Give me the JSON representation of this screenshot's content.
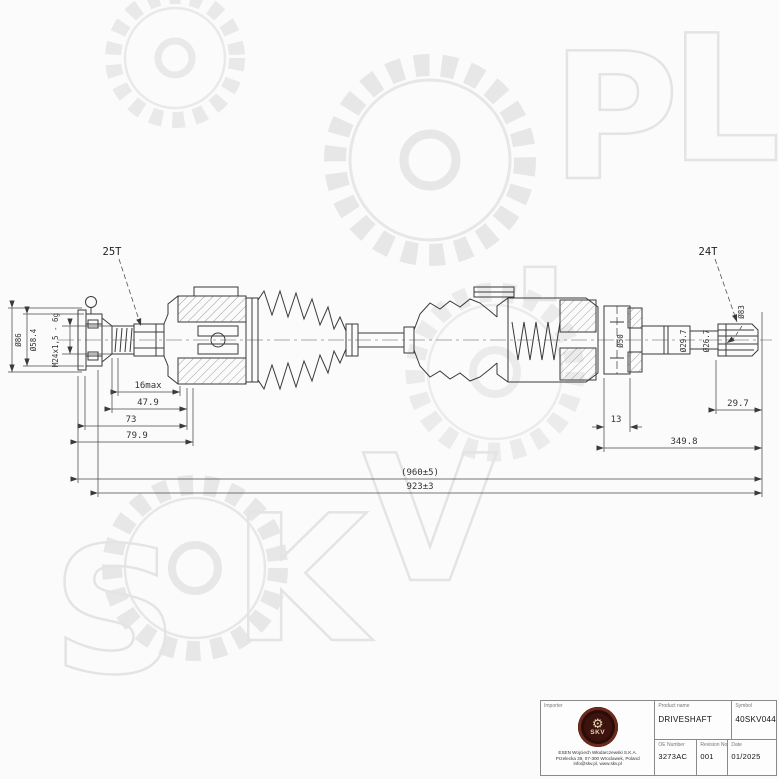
{
  "watermark": {
    "letters": [
      "S",
      "K",
      "V",
      ".",
      "P",
      "L"
    ]
  },
  "drawing": {
    "labels": {
      "spline_left": "25T",
      "spline_right": "24T"
    },
    "dims": {
      "dia_86": "Ø86",
      "dia_58_4": "Ø58.4",
      "thread": "M24x1,5 - 6g",
      "len_16max": "16max",
      "len_47_9": "47.9",
      "len_73": "73",
      "len_79_9": "79.9",
      "dia_50": "Ø50",
      "dia_29_7": "Ø29.7",
      "dia_26_7": "Ø26.7",
      "dia_83": "Ø83",
      "len_13": "13",
      "len_349_8": "349.8",
      "len_29_7": "29.7",
      "len_total_ref": "(960±5)",
      "len_total": "923±3"
    }
  },
  "title_block": {
    "importer_label": "Importer",
    "logo_gear_icon": "⚙",
    "logo_text": "SKV",
    "address_line_1": "ESEN Wojciech Włodarczewski S.K.A.",
    "address_line_2": "Przelecka 39, 07-300 Wroclawek, Poland",
    "address_line_3": "info@skv.pl, www.skv.pl",
    "product_name_label": "Product name",
    "product_name": "DRIVESHAFT",
    "symbol_label": "Symbol",
    "symbol": "40SKV044",
    "oe_number_label": "OE Number",
    "oe_number": "3273AC",
    "revision_label": "Revision No",
    "revision": "001",
    "date_label": "Date",
    "date": "01/2025"
  }
}
